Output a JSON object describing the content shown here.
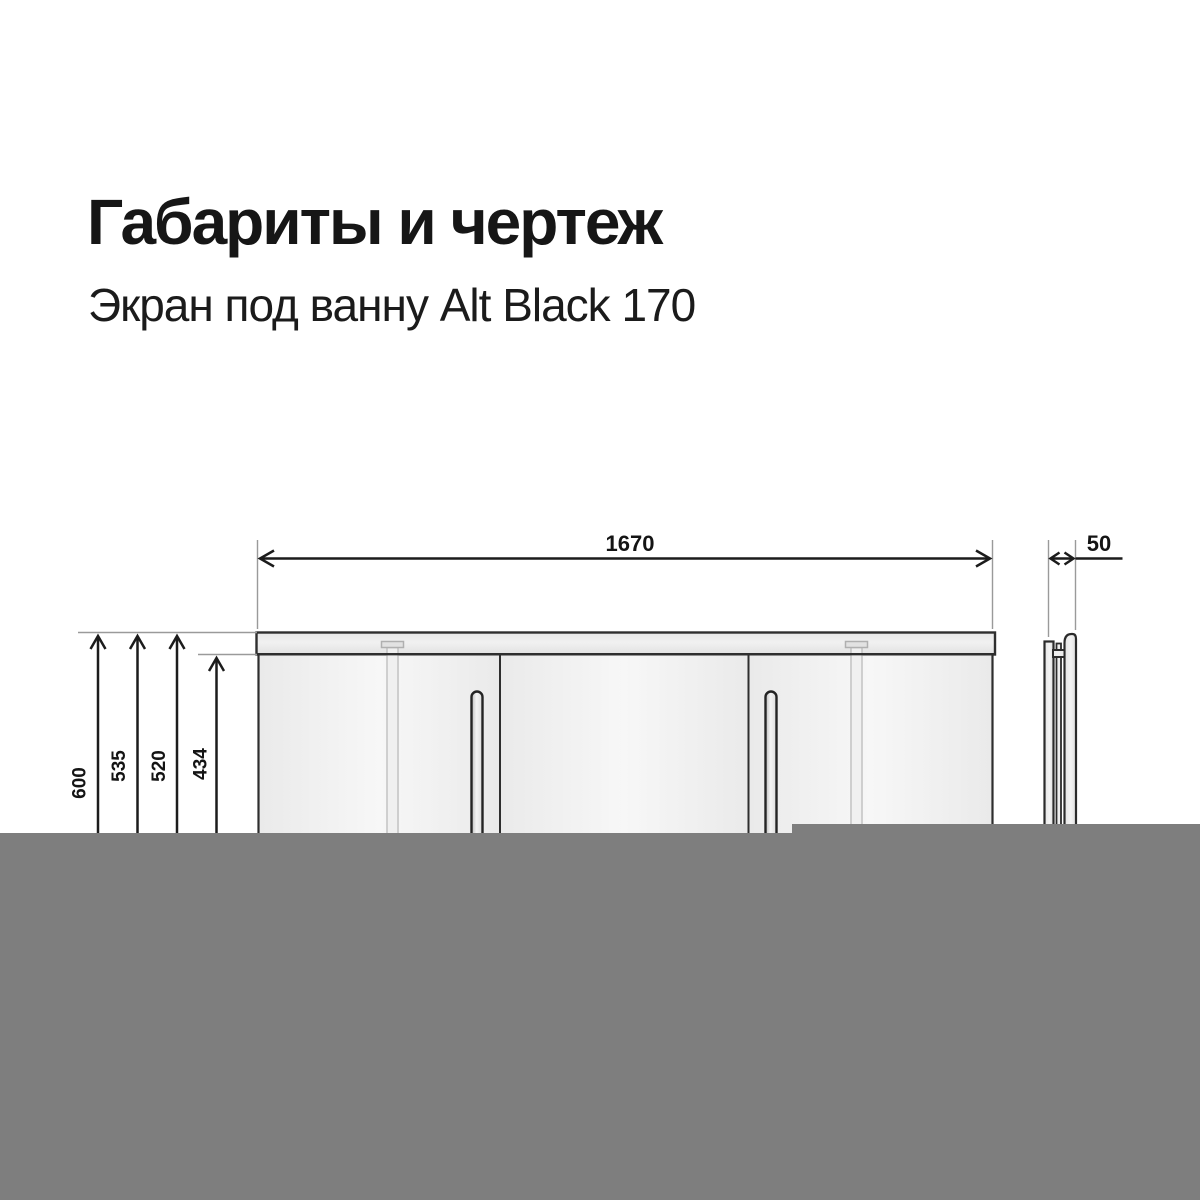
{
  "header": {
    "title": "Габариты и чертеж",
    "subtitle": "Экран под ванну Alt Black 170"
  },
  "drawing": {
    "dimension_width": "1670",
    "dimension_depth": "50",
    "dimension_heights": [
      "600",
      "535",
      "520",
      "434"
    ]
  },
  "colors": {
    "background": "#ffffff",
    "text": "#161616",
    "outline": "#2e2e2e",
    "dimension_line": "#1c1c1c",
    "extension_line": "#9a9a9a",
    "rail_fill": "#e9e9e9",
    "panel_fill": "#f2f2f2",
    "leg_fill": "#ededed",
    "overlay_gray": "#7e7e7e"
  }
}
